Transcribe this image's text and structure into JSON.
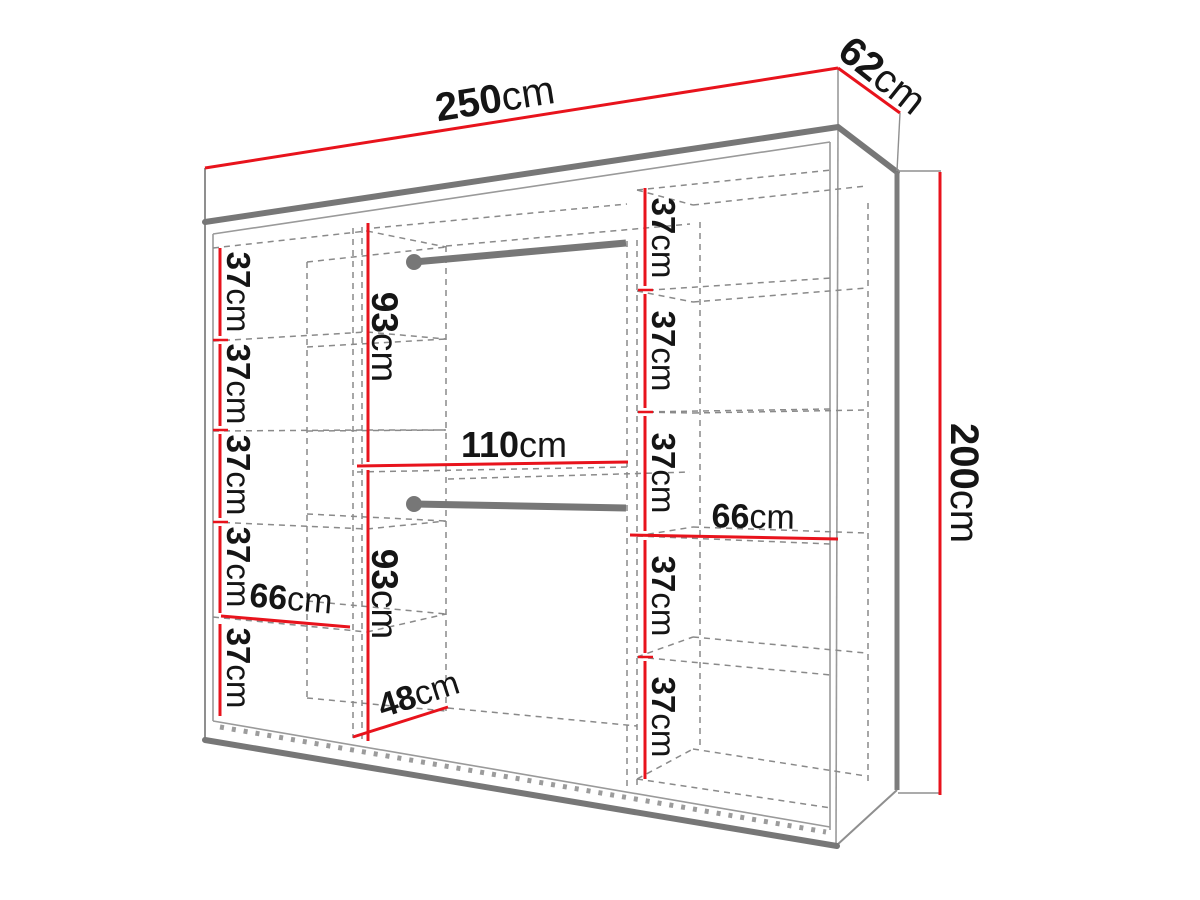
{
  "diagram": {
    "type": "wardrobe-dimension-diagram",
    "unit": "cm",
    "colors": {
      "dimension_line": "#e8131c",
      "outline": "#8c8c8c",
      "rail": "#777777",
      "text": "#151515",
      "background": "#ffffff"
    },
    "overall": {
      "width": {
        "value": "250",
        "unit": "cm"
      },
      "depth": {
        "value": "62",
        "unit": "cm"
      },
      "height": {
        "value": "200",
        "unit": "cm"
      }
    },
    "left_column": {
      "width": {
        "value": "66",
        "unit": "cm"
      },
      "shelves": [
        {
          "value": "37",
          "unit": "cm"
        },
        {
          "value": "37",
          "unit": "cm"
        },
        {
          "value": "37",
          "unit": "cm"
        },
        {
          "value": "37",
          "unit": "cm"
        },
        {
          "value": "37",
          "unit": "cm"
        }
      ]
    },
    "middle_section": {
      "width": {
        "value": "110",
        "unit": "cm"
      },
      "upper_hanging_height": {
        "value": "93",
        "unit": "cm"
      },
      "lower_hanging_height": {
        "value": "93",
        "unit": "cm"
      },
      "base_depth": {
        "value": "48",
        "unit": "cm"
      },
      "hanging_rails": 2
    },
    "right_column": {
      "width": {
        "value": "66",
        "unit": "cm"
      },
      "shelves": [
        {
          "value": "37",
          "unit": "cm"
        },
        {
          "value": "37",
          "unit": "cm"
        },
        {
          "value": "37",
          "unit": "cm"
        },
        {
          "value": "37",
          "unit": "cm"
        },
        {
          "value": "37",
          "unit": "cm"
        }
      ]
    }
  }
}
